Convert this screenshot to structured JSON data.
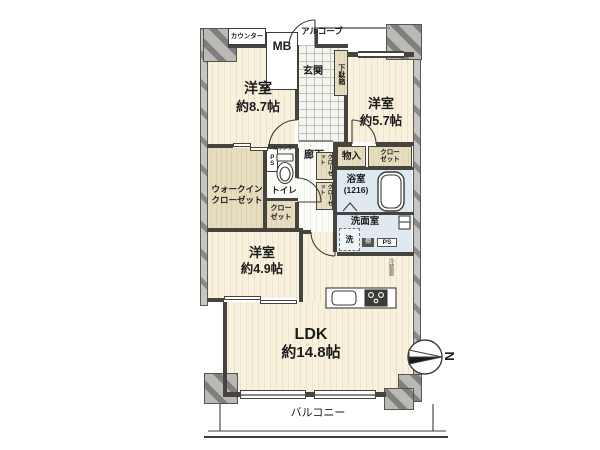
{
  "floorplan": {
    "type": "japanese-apartment-floor-plan",
    "labels": {
      "counter": "カウンター",
      "meter_box": "MB",
      "alcove": "アルコーブ",
      "entrance": "玄関",
      "shoe_box": "下駄箱",
      "bedroom1_name": "洋室",
      "bedroom1_size": "約8.7帖",
      "bedroom2_name": "洋室",
      "bedroom2_size": "約5.7帖",
      "bedroom3_name": "洋室",
      "bedroom3_size": "約4.9帖",
      "ldk_name": "LDK",
      "ldk_size": "約14.8帖",
      "hallway": "廊下",
      "pipe_space_top": "PS",
      "toilet": "トイレ",
      "toilet_counter": "カウンター",
      "wic_line1": "ウォークイン",
      "wic_line2": "クローゼット",
      "closet_line1": "クロー",
      "closet_line2": "ゼット",
      "closet_mid_a": "クローゼット",
      "closet_mid_b": "クローゼット",
      "storage": "物入",
      "bathroom": "浴室",
      "bathroom_size": "(1216)",
      "washroom": "洗面室",
      "washer": "洗",
      "shelf": "棚",
      "pipe_space_bottom": "PS",
      "refrigerator": "冷蔵庫",
      "balcony": "バルコニー",
      "compass_north": "N"
    },
    "colors": {
      "room_floor": "#f7f1de",
      "room_stripe": "#ece3ca",
      "storage_floor": "#e2d7b8",
      "wet_floor": "#dfe9f1",
      "entrance_tile": "#f5f5f0",
      "wall": "#45443f",
      "exterior_wall": "#c7c6c2",
      "hatch": "#8b8a86",
      "background": "#ffffff"
    }
  }
}
